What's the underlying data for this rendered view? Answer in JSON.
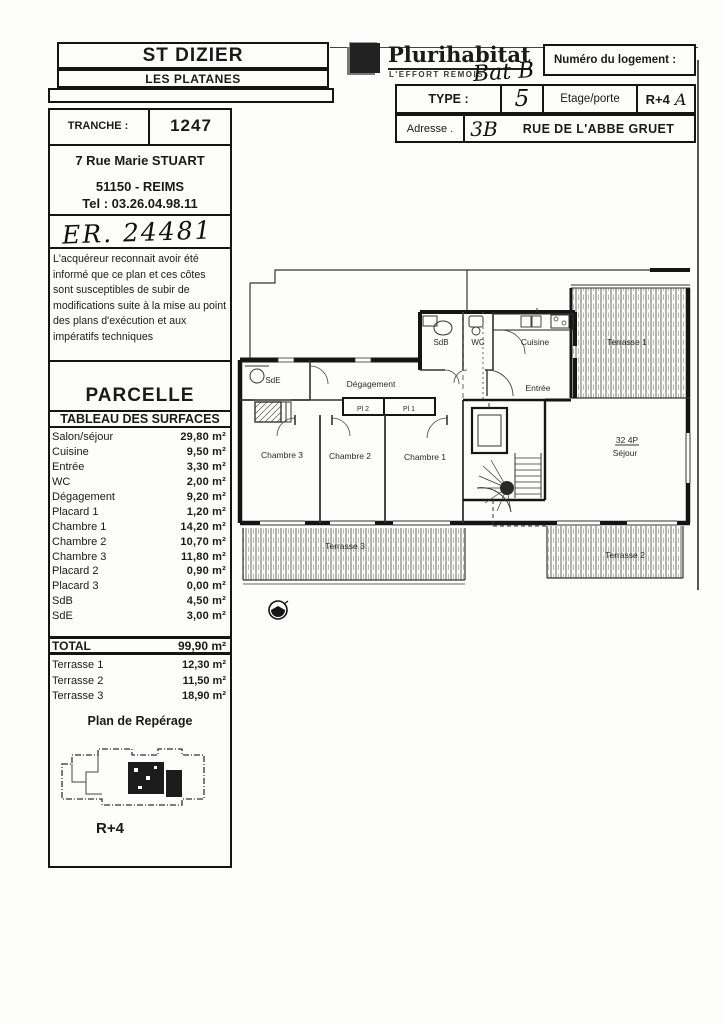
{
  "header": {
    "site_title": "ST DIZIER",
    "site_subtitle": "LES PLATANES",
    "tranche_label": "TRANCHE :",
    "tranche_value": "1247",
    "office_address_line1": "7 Rue Marie STUART",
    "office_address_line2": "51150 - REIMS",
    "office_phone": "Tel : 03.26.04.98.11",
    "handwritten_ref": "ER. 24481"
  },
  "logo": {
    "brand": "Plurihabitat",
    "tagline": "L'EFFORT REMOIS",
    "handwritten_building": "Bat B"
  },
  "unit_info": {
    "numero_label": "Numéro du logement :",
    "type_label": "TYPE :",
    "type_value": "5",
    "etage_label": "Etage/porte",
    "etage_value": "R+4",
    "porte_value": "A",
    "adresse_label": "Adresse .",
    "adresse_number": "3B",
    "adresse_value": "RUE DE L'ABBE GRUET"
  },
  "disclaimer": "L'acquéreur reconnait avoir été informé que ce plan et ces côtes sont susceptibles de subir de modifications suite à la mise au point des plans d'exécution et aux impératifs techniques",
  "surfaces": {
    "parcelle_title": "PARCELLE",
    "table_title": "TABLEAU DES SURFACES",
    "rows": [
      {
        "label": "Salon/séjour",
        "value": "29,80 m²"
      },
      {
        "label": "Cuisine",
        "value": "9,50 m²"
      },
      {
        "label": "Entrée",
        "value": "3,30 m²"
      },
      {
        "label": "WC",
        "value": "2,00 m²"
      },
      {
        "label": "Dégagement",
        "value": "9,20 m²"
      },
      {
        "label": "Placard 1",
        "value": "1,20 m²"
      },
      {
        "label": "Chambre 1",
        "value": "14,20 m²"
      },
      {
        "label": "Chambre 2",
        "value": "10,70 m²"
      },
      {
        "label": "Chambre 3",
        "value": "11,80 m²"
      },
      {
        "label": "Placard 2",
        "value": "0,90 m²"
      },
      {
        "label": "Placard 3",
        "value": "0,00 m²"
      },
      {
        "label": "SdB",
        "value": "4,50 m²"
      },
      {
        "label": "SdE",
        "value": "3,00 m²"
      }
    ],
    "total_label": "TOTAL",
    "total_value": "99,90 m²",
    "terrasses": [
      {
        "label": "Terrasse 1",
        "value": "12,30 m²"
      },
      {
        "label": "Terrasse 2",
        "value": "11,50 m²"
      },
      {
        "label": "Terrasse 3",
        "value": "18,90 m²"
      }
    ],
    "reperage_title": "Plan de Repérage",
    "reperage_level": "R+4"
  },
  "floorplan": {
    "sdb": "SdB",
    "wc": "WC",
    "cuisine": "Cuisine",
    "terrasse1": "Terrasse 1",
    "entree": "Entrée",
    "degagement": "Dégagement",
    "sde": "SdE",
    "pl2": "Pl 2",
    "pl1": "Pl 1",
    "chambre3": "Chambre 3",
    "chambre2": "Chambre 2",
    "chambre1": "Chambre 1",
    "unit_label": "32 4P",
    "sejour": "Séjour",
    "terrasse3": "Terrasse 3",
    "terrasse2": "Terrasse 2"
  },
  "colors": {
    "ink": "#1a1a1a",
    "paper": "#fdfdfc"
  }
}
